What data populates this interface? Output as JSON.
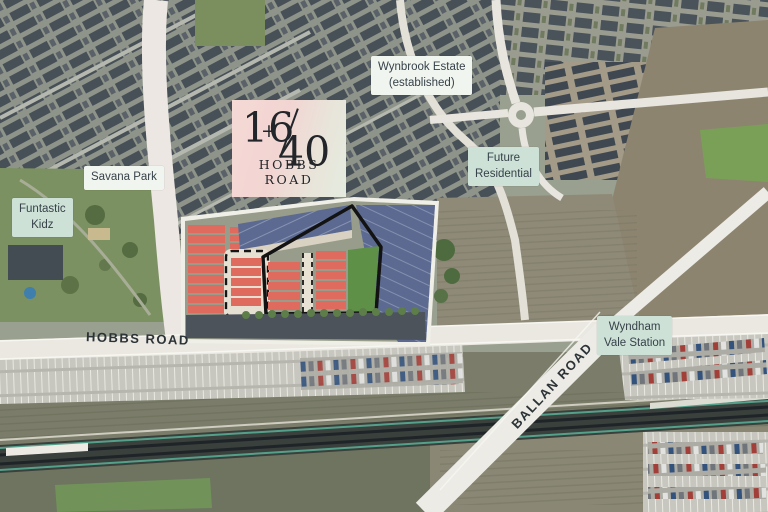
{
  "map": {
    "logo": {
      "number_left": "16",
      "plus": "+",
      "number_right": "40",
      "subtitle": "HOBBS ROAD"
    },
    "labels": {
      "wynbrook_estate": {
        "line1": "Wynbrook Estate",
        "line2": "(established)"
      },
      "future_residential": {
        "line1": "Future",
        "line2": "Residential"
      },
      "savana_park": {
        "text": "Savana Park"
      },
      "funtastic_kidz": {
        "line1": "Funtastic",
        "line2": "Kidz"
      },
      "wyndham_vale_station": {
        "line1": "Wyndham",
        "line2": "Vale Station"
      }
    },
    "roads": {
      "hobbs": "HOBBS ROAD",
      "ballan": "BALLAN ROAD"
    }
  },
  "colors": {
    "lot_red": "#df6a5e",
    "lot_navy": "#5c6a92",
    "plan_green": "#5e9147",
    "label_white": "#f1f5ef",
    "label_mint": "#cde1d6",
    "label_text": "#37424a",
    "road_text": "#2c3337",
    "logo_pink": "#f5d9d5",
    "logo_green": "#e4ecdf"
  }
}
